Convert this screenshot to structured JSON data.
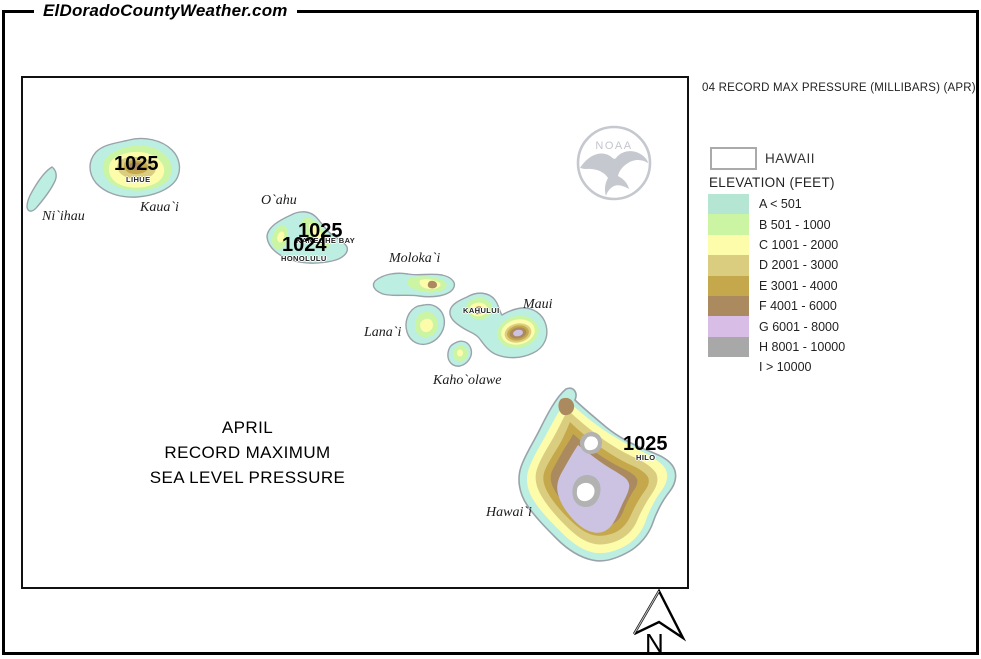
{
  "header": {
    "site_title": "ElDoradoCountyWeather.com"
  },
  "map": {
    "caption_lines": [
      "APRIL",
      "RECORD MAXIMUM",
      "SEA LEVEL PRESSURE"
    ],
    "noaa_logo_label": "NOAA",
    "north_arrow_label": "N",
    "island_labels": [
      "Ni`ihau",
      "Kaua`i",
      "O`ahu",
      "Moloka`i",
      "Lana`i",
      "Maui",
      "Kaho`olawe",
      "Hawai`i"
    ],
    "stations": [
      {
        "name": "LIHUE",
        "pressure": "1025"
      },
      {
        "name": "KANEOHE BAY",
        "pressure": "1025"
      },
      {
        "name": "HONOLULU",
        "pressure": "1024"
      },
      {
        "name": "KAHULUI"
      },
      {
        "name": "HILO",
        "pressure": "1025"
      }
    ]
  },
  "legend": {
    "title": "04 RECORD MAX PRESSURE (MILLIBARS) (APR)",
    "region_label": "HAWAII",
    "section_label": "ELEVATION (FEET)",
    "classes": [
      {
        "label": "A < 501",
        "color": "#b5e5d3"
      },
      {
        "label": "B 501 - 1000",
        "color": "#cbf5a2"
      },
      {
        "label": "C 1001 - 2000",
        "color": "#fcfcaa"
      },
      {
        "label": "D 2001 - 3000",
        "color": "#dbcd80"
      },
      {
        "label": "E 3001 - 4000",
        "color": "#c4a84b"
      },
      {
        "label": "F 4001 - 6000",
        "color": "#aa8a5e"
      },
      {
        "label": "G 6001 - 8000",
        "color": "#d8bde6"
      },
      {
        "label": "H 8001 - 10000",
        "color": "#a8a8a8"
      },
      {
        "label": "I > 10000",
        "color": "#ffffff"
      }
    ]
  }
}
